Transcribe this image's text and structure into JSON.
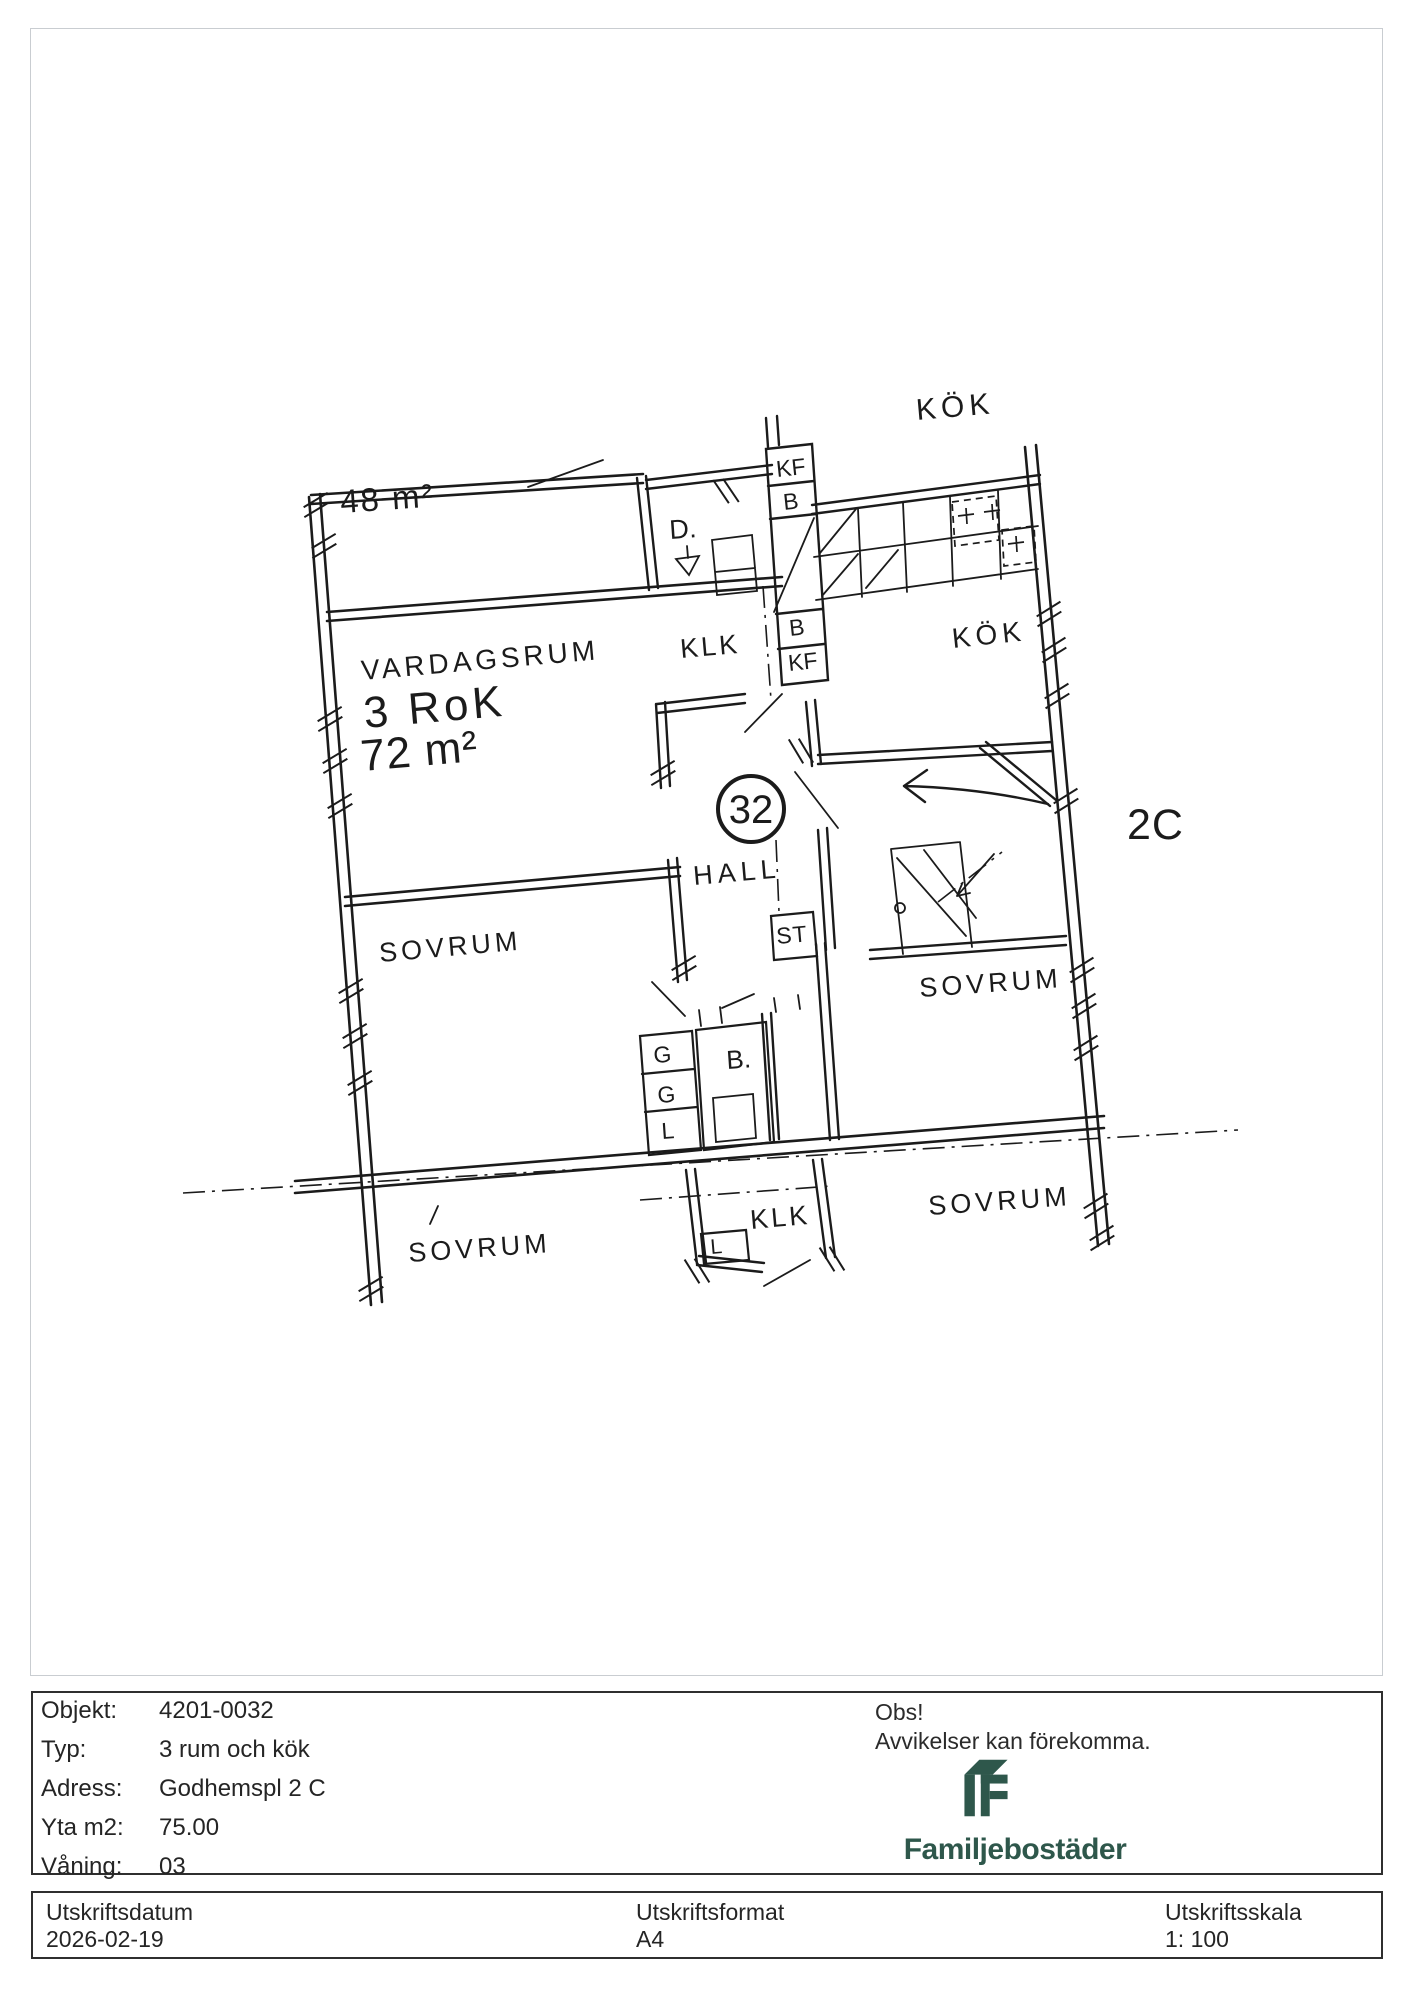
{
  "plan": {
    "labels": {
      "neighbor_kok": "KÖK",
      "neighbor_area": "48 m²",
      "vardagsrum": "VARDAGSRUM",
      "rooms_summary": "3 RoK",
      "area": "72 m²",
      "d": "D.",
      "klk_upper": "KLK",
      "kf_upper": "KF",
      "b_upper": "B",
      "b_mid": "B",
      "kf_mid": "KF",
      "kok": "KÖK",
      "hall": "HALL",
      "st": "ST",
      "apartment_number": "32",
      "entrance": "2C",
      "sovrum_mid_left": "SOVRUM",
      "sovrum_upper_right": "SOVRUM",
      "sovrum_lower_left": "SOVRUM",
      "sovrum_lower_right": "SOVRUM",
      "g_top": "G",
      "g_mid": "G",
      "l_top": "L",
      "bathroom": "B.",
      "klk_lower": "KLK",
      "l_lower": "L"
    }
  },
  "footer": {
    "rows": [
      {
        "label": "Objekt:",
        "value": "4201-0032"
      },
      {
        "label": "Typ:",
        "value": "3 rum och kök"
      },
      {
        "label": "Adress:",
        "value": "Godhemspl 2 C"
      },
      {
        "label": "Yta m2:",
        "value": "75.00"
      },
      {
        "label": "Våning:",
        "value": "03"
      }
    ],
    "notice_title": "Obs!",
    "notice_text": "Avvikelser kan förekomma.",
    "brand": "Familjebostäder"
  },
  "printbar": {
    "columns": [
      {
        "label": "Utskriftsdatum",
        "value": "2026-02-19"
      },
      {
        "label": "Utskriftsformat",
        "value": "A4"
      },
      {
        "label": "Utskriftsskala",
        "value": "1: 100"
      }
    ]
  },
  "colors": {
    "brand_green": "#2E574B",
    "ink": "#1b1b1b"
  }
}
